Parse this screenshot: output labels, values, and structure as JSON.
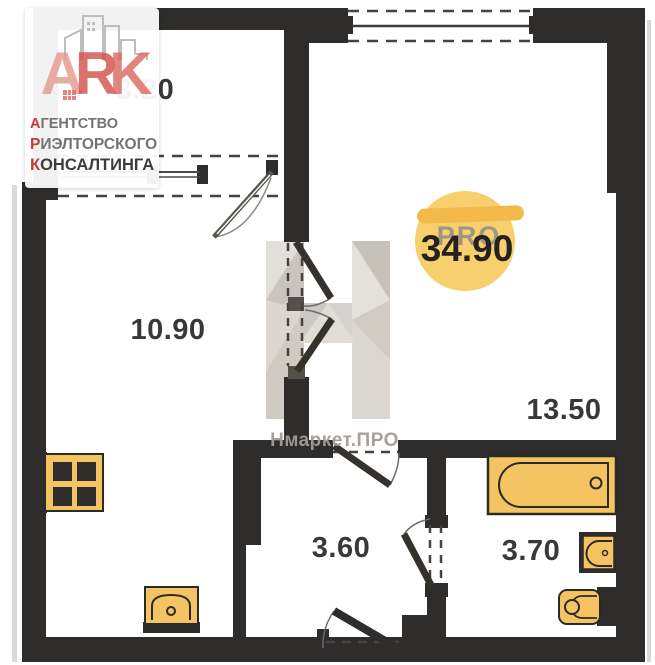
{
  "logo": {
    "ark": [
      "A",
      "R",
      "K"
    ],
    "lines": [
      {
        "initial": "А",
        "rest": "ГЕНТСТВО"
      },
      {
        "initial": "Р",
        "rest": "ИЭЛТОРСКОГО"
      },
      {
        "initial": "К",
        "rest": "ОНСАЛТИНГА"
      }
    ]
  },
  "badge": {
    "total_area": "34.90",
    "watermark": "PRO",
    "circle_color": "#f6cb63",
    "bar_color": "#f3ba4a"
  },
  "watermark": {
    "letter": "Н",
    "caption": "Нмаркет.ПРО"
  },
  "rooms": {
    "balcony": {
      "area": "3.20"
    },
    "kitchen_living": {
      "area": "10.90"
    },
    "living_room": {
      "area": "13.50"
    },
    "hallway": {
      "area": "3.60"
    },
    "bathroom": {
      "area": "3.70"
    }
  },
  "colors": {
    "wall": "#2e2d2c",
    "fixture_yellow": "#f5c462",
    "accent_red": "#c63b34",
    "watermark_gray": "#d6d2cb"
  }
}
